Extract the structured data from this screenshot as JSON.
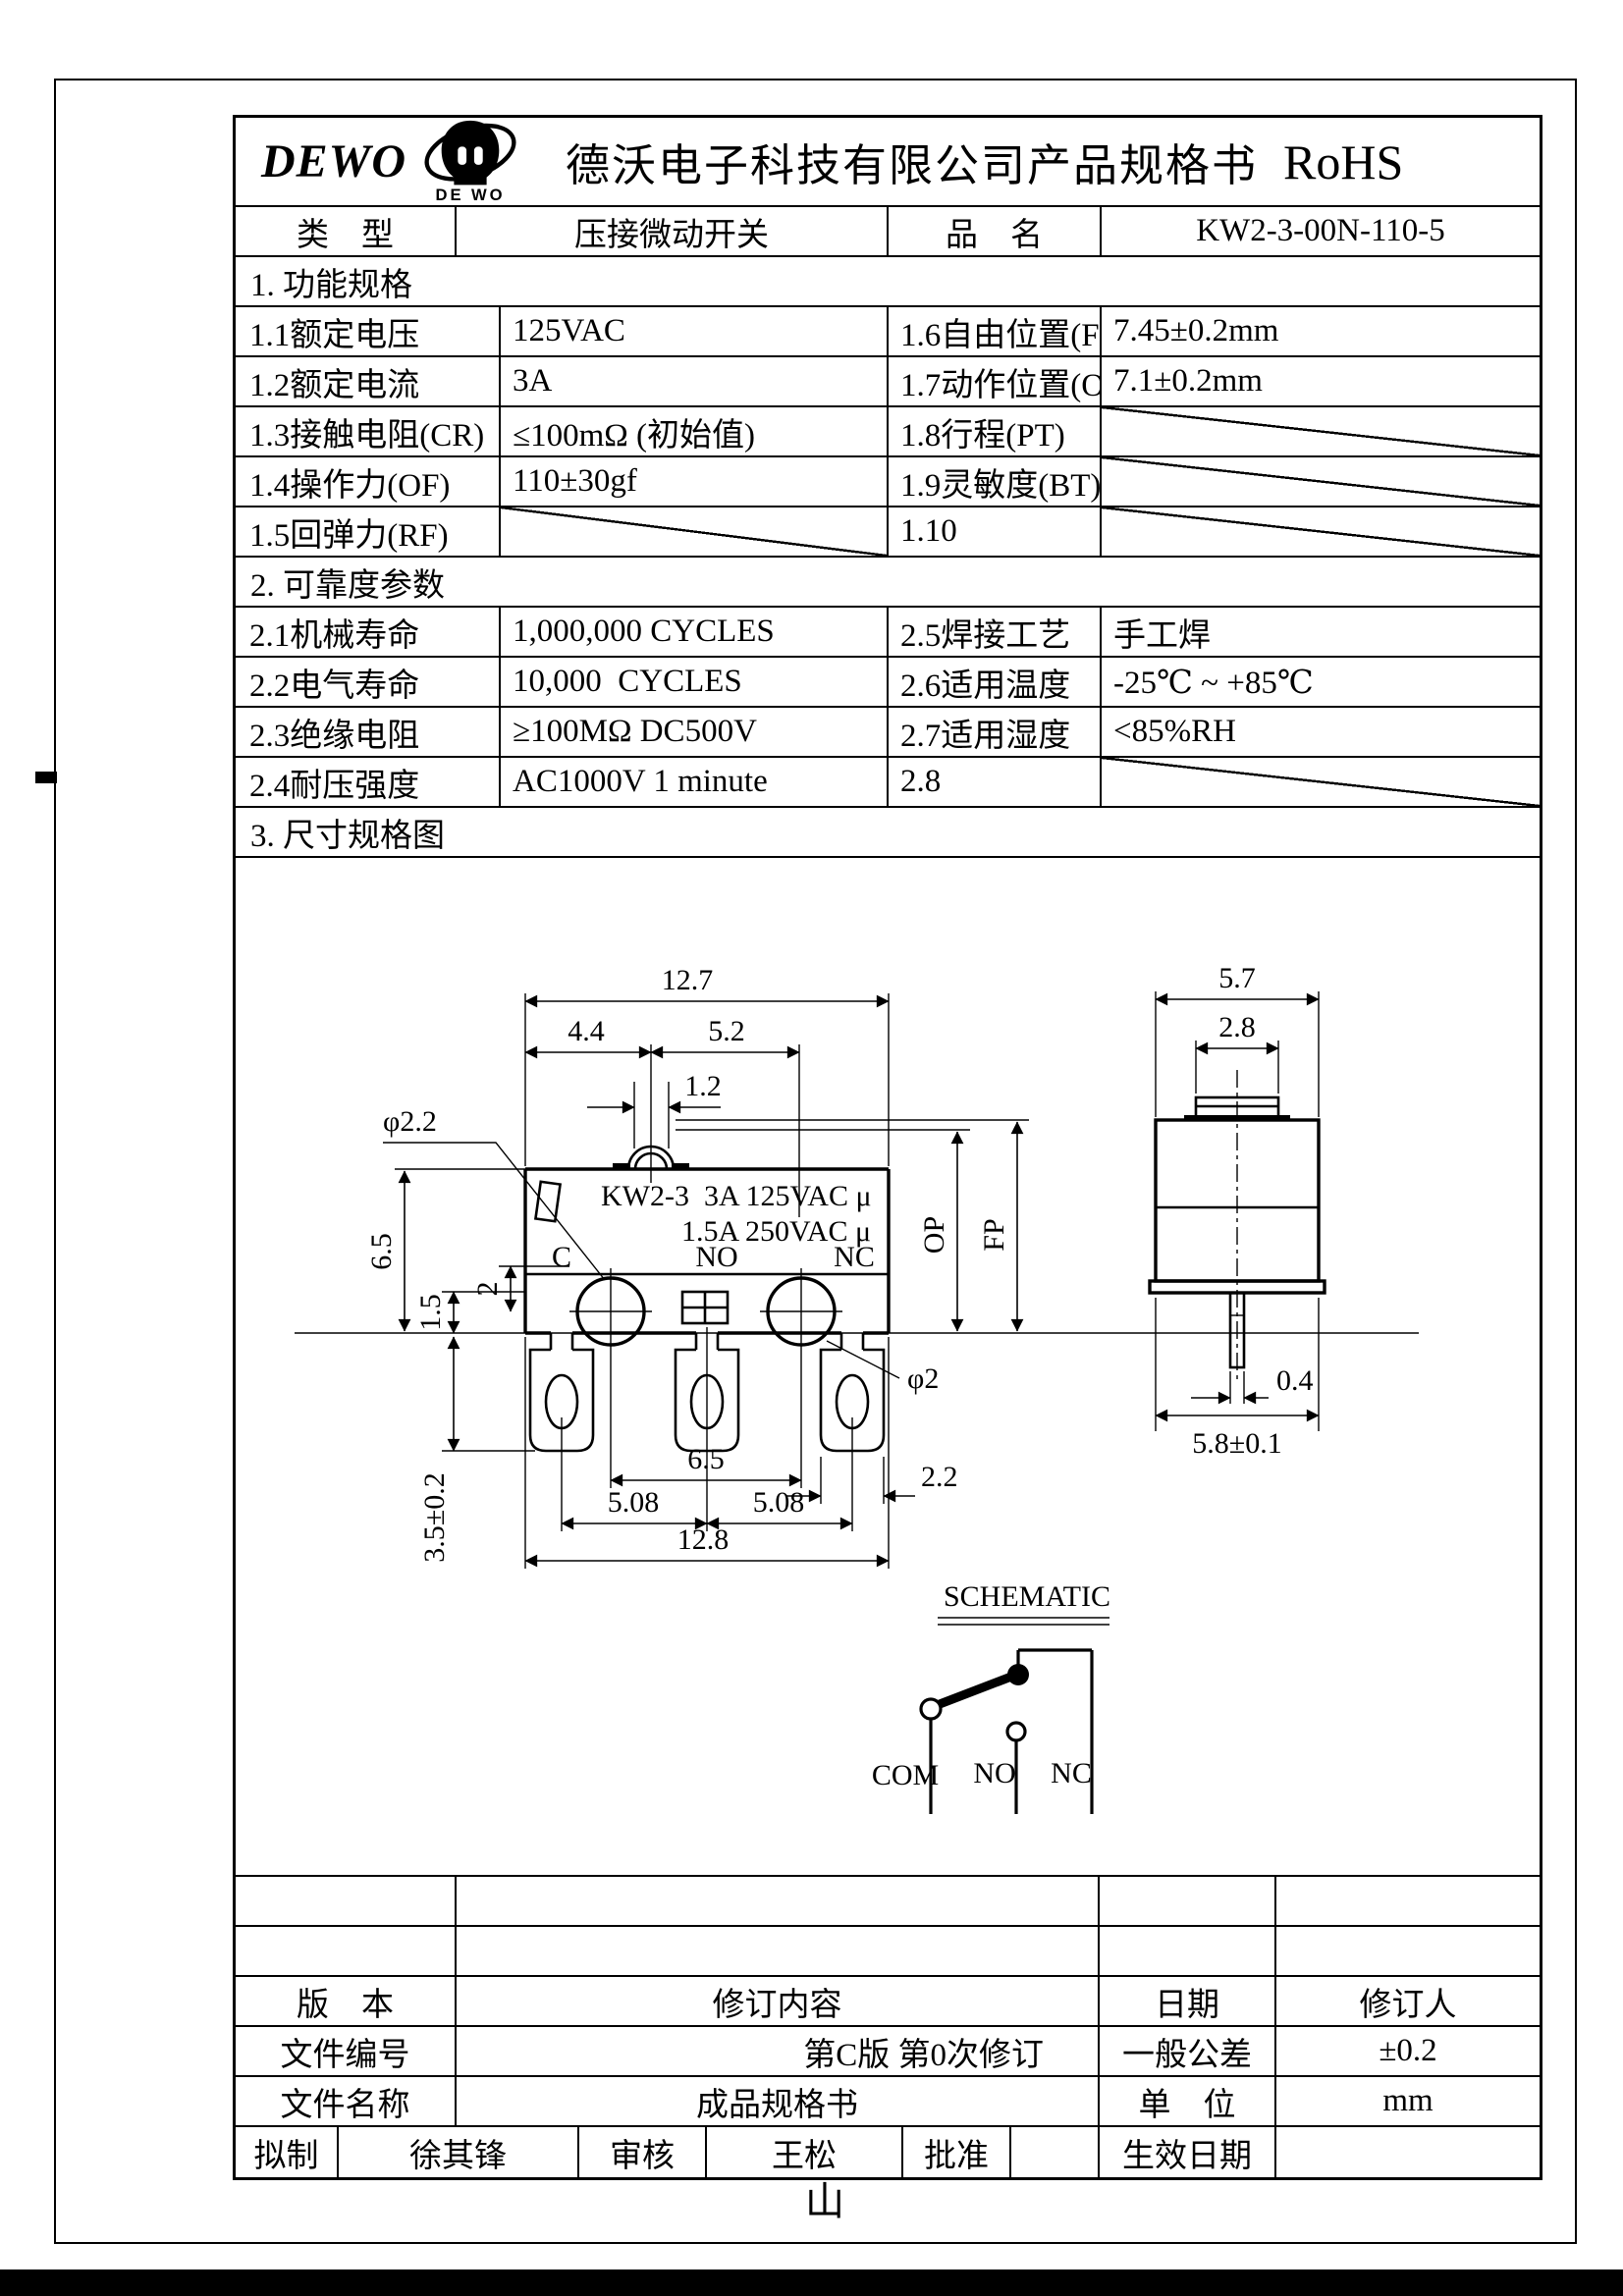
{
  "header": {
    "logo": "DEWO",
    "logo_sub": "DE WO",
    "title": "德沃电子科技有限公司产品规格书",
    "cert": "RoHS"
  },
  "type_row": {
    "type_label": "类　型",
    "type_value": "压接微动开关",
    "name_label": "品　名",
    "name_value": "KW2-3-00N-110-5"
  },
  "sections": {
    "s1": "1. 功能规格",
    "s2": "2. 可靠度参数",
    "s3": "3. 尺寸规格图"
  },
  "spec1": {
    "r1": {
      "l1": "1.1额定电压",
      "v1": "125VAC",
      "l2": "1.6自由位置(FP)",
      "v2": "7.45±0.2mm"
    },
    "r2": {
      "l1": "1.2额定电流",
      "v1": "3A",
      "l2": "1.7动作位置(OP)",
      "v2": "7.1±0.2mm"
    },
    "r3": {
      "l1": "1.3接触电阻(CR)",
      "v1": "≤100mΩ (初始值)",
      "l2": "1.8行程(PT)",
      "v2": ""
    },
    "r4": {
      "l1": "1.4操作力(OF)",
      "v1": "110±30gf",
      "l2": "1.9灵敏度(BT)",
      "v2": ""
    },
    "r5": {
      "l1": "1.5回弹力(RF)",
      "v1": "",
      "l2": "1.10",
      "v2": ""
    }
  },
  "spec2": {
    "r1": {
      "l1": "2.1机械寿命",
      "v1": "1,000,000 CYCLES",
      "l2": "2.5焊接工艺",
      "v2": "手工焊"
    },
    "r2": {
      "l1": "2.2电气寿命",
      "v1": "10,000  CYCLES",
      "l2": "2.6适用温度",
      "v2": "-25℃ ~ +85℃"
    },
    "r3": {
      "l1": "2.3绝缘电阻",
      "v1": "≥100MΩ DC500V",
      "l2": "2.7适用湿度",
      "v2": "<85%RH"
    },
    "r4": {
      "l1": "2.4耐压强度",
      "v1": "AC1000V 1 minute",
      "l2": "2.8",
      "v2": ""
    }
  },
  "drawing": {
    "front": {
      "w": "12.7",
      "seg_l": "4.4",
      "seg_r": "5.2",
      "btn": "1.2",
      "hole": "φ2.2",
      "h": "6.5",
      "step": "2",
      "lip": "1.5",
      "pin_len": "3.5±0.2",
      "op": "OP",
      "fp": "FP",
      "pin_hole": "φ2",
      "hole_span": "6.5",
      "pin_w": "2.2",
      "pitch1": "5.08",
      "pitch2": "5.08",
      "base": "12.8",
      "mark1": "KW2-3  3A 125VAC μ",
      "mark2": "1.5A 250VAC μ",
      "c": "C",
      "no": "NO",
      "nc": "NC"
    },
    "side": {
      "w": "5.7",
      "btn": "2.8",
      "pin": "0.4",
      "h": "5.8±0.1"
    },
    "schematic": {
      "title": "SCHEMATIC",
      "com": "COM",
      "no": "NO",
      "nc": "NC"
    }
  },
  "revision": {
    "version_label": "版　本",
    "content_label": "修订内容",
    "date_label": "日期",
    "by_label": "修订人",
    "doc_no_label": "文件编号",
    "rev_note": "第C版 第0次修订",
    "tolerance_label": "一般公差",
    "tolerance": "±0.2",
    "doc_name_label": "文件名称",
    "doc_name": "成品规格书",
    "unit_label": "单　位",
    "unit": "mm",
    "draft_label": "拟制",
    "draft": "徐其锋",
    "check_label": "审核",
    "check": "王松",
    "approve_label": "批准",
    "effective_label": "生效日期"
  },
  "footer": {
    "mark": "山"
  }
}
